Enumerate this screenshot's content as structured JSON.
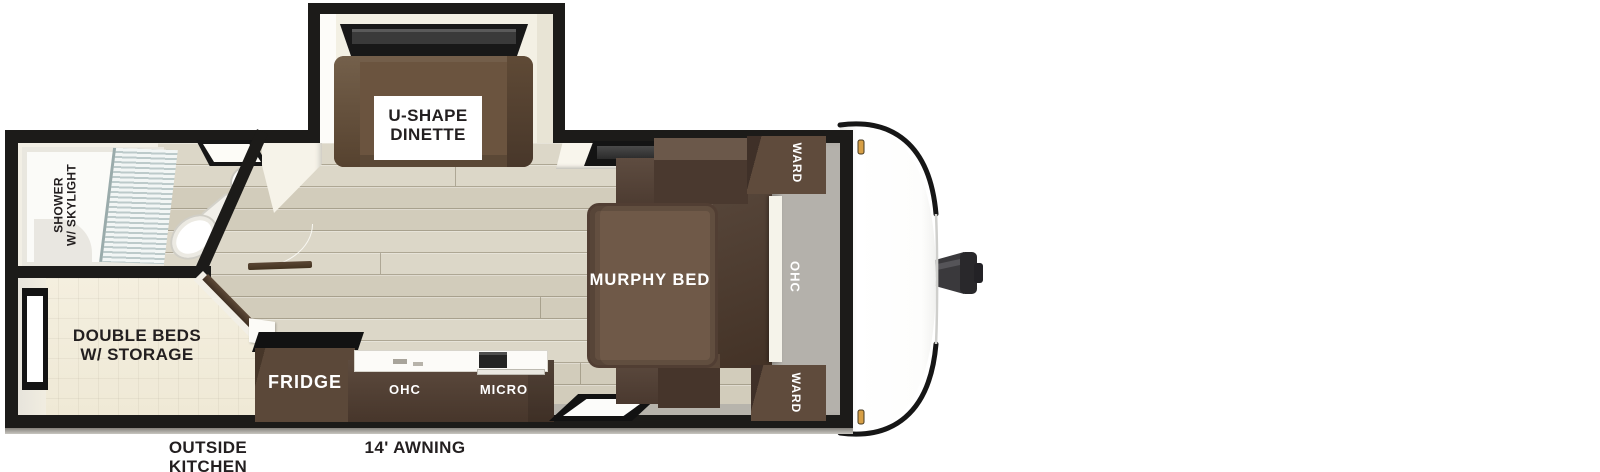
{
  "title": "Travel trailer floor plan",
  "labels": {
    "dinette": {
      "line1": "U-SHAPE",
      "line2": "DINETTE"
    },
    "shower": {
      "line1": "SHOWER",
      "line2": "W/ SKYLIGHT"
    },
    "double_beds": {
      "line1": "DOUBLE BEDS",
      "line2": "W/ STORAGE"
    },
    "murphy_bed": "MURPHY BED",
    "fridge": "FRIDGE",
    "kitchen_ohc": "OHC",
    "micro": "MICRO",
    "ward_top": "WARD",
    "ward_bottom": "WARD",
    "front_ohc": "OHC",
    "outside_kitchen": {
      "line1": "OUTSIDE",
      "line2": "KITCHEN"
    },
    "awning": "14' AWNING"
  },
  "colors": {
    "wall_black": "#1c1b19",
    "ivory_wall": "#f6f3e9",
    "floor_plank": "#d8d3c3",
    "room_cream": "#f3eedd",
    "front_grey": "#b4b1ab",
    "cabinet_dark": "#4a392f",
    "cabinet_mid": "#5c4a3e",
    "murphy_bed_brown": "#6f5948",
    "dinette_brown": "#6b543f",
    "label_dark": "#231f20",
    "label_white": "#ffffff",
    "marker_amber": "#d79f45"
  }
}
